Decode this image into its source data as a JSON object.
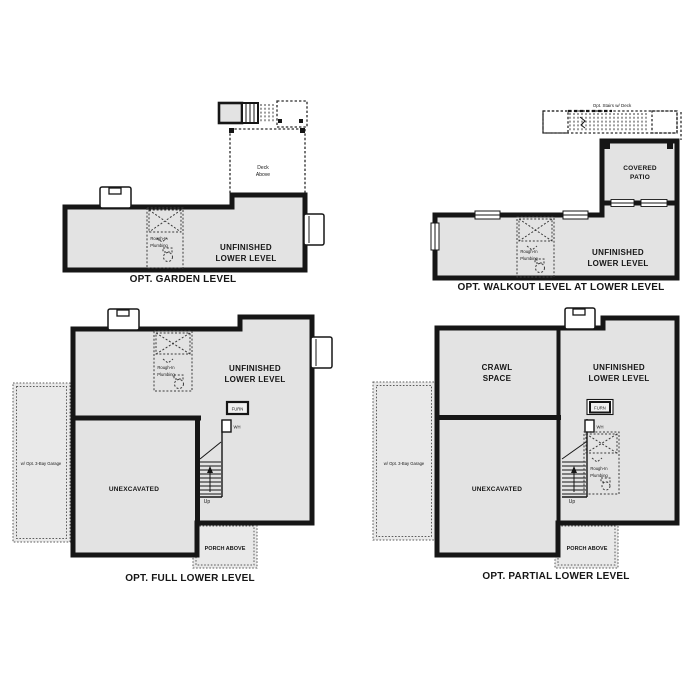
{
  "colors": {
    "wall": "#161616",
    "room_fill": "#e3e3e3",
    "overlay_fill": "#e9e9e9",
    "background": "#ffffff"
  },
  "plans": {
    "garden": {
      "title": "OPT. GARDEN LEVEL",
      "labels": {
        "deck_above": [
          "Deck",
          "Above"
        ],
        "unfinished": [
          "UNFINISHED",
          "LOWER LEVEL"
        ],
        "rough_in": [
          "Rough-In",
          "Plumbing"
        ]
      }
    },
    "walkout": {
      "title": "OPT. WALKOUT LEVEL AT LOWER LEVEL",
      "labels": {
        "opt_stairs": "Opt. Stairs w/ Deck",
        "covered_patio": [
          "COVERED",
          "PATIO"
        ],
        "unfinished": [
          "UNFINISHED",
          "LOWER LEVEL"
        ],
        "rough_in": [
          "Rough-In",
          "Plumbing"
        ]
      }
    },
    "full": {
      "title": "OPT. FULL LOWER LEVEL",
      "labels": {
        "unfinished": [
          "UNFINISHED",
          "LOWER LEVEL"
        ],
        "unexcavated": "UNEXCAVATED",
        "garage": "w/ Opt. 3-Bay Garage",
        "porch": "PORCH ABOVE",
        "furn": "FURN",
        "wh": "WH",
        "up": "Up",
        "rough_in": [
          "Rough-In",
          "Plumbing"
        ]
      }
    },
    "partial": {
      "title": "OPT. PARTIAL LOWER LEVEL",
      "labels": {
        "crawl_space": [
          "CRAWL",
          "SPACE"
        ],
        "unfinished": [
          "UNFINISHED",
          "LOWER LEVEL"
        ],
        "unexcavated": "UNEXCAVATED",
        "garage": "w/ Opt. 3-Bay Garage",
        "porch": "PORCH ABOVE",
        "furn": "FURN",
        "wh": "WH",
        "up": "Up",
        "rough_in": [
          "Rough-In",
          "Plumbing"
        ]
      }
    }
  }
}
